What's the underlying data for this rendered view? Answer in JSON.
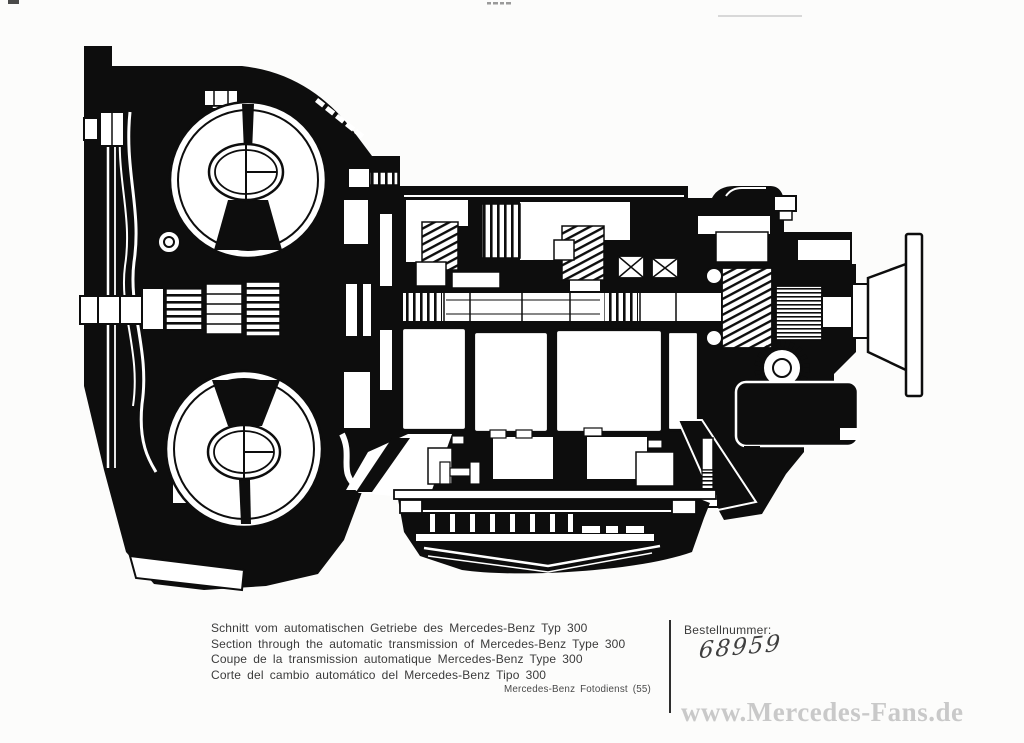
{
  "colors": {
    "ink": "#0d0d0d",
    "paper": "#fcfcfb",
    "caption_text": "#3b3b3b",
    "watermark_gray": "#c9c9c9"
  },
  "caption": {
    "lines": [
      "Schnitt vom automatischen Getriebe des Mercedes-Benz Typ 300",
      "Section through the automatic transmission of Mercedes-Benz Type 300",
      "Coupe de la transmission automatique Mercedes-Benz Type 300",
      "Corte del cambio automático del Mercedes-Benz Tipo 300"
    ],
    "credit": "Mercedes-Benz Fotodienst (55)"
  },
  "order": {
    "label": "Bestellnummer:",
    "number": "68959"
  },
  "watermark": {
    "text": "www.Mercedes-Fans.de"
  }
}
